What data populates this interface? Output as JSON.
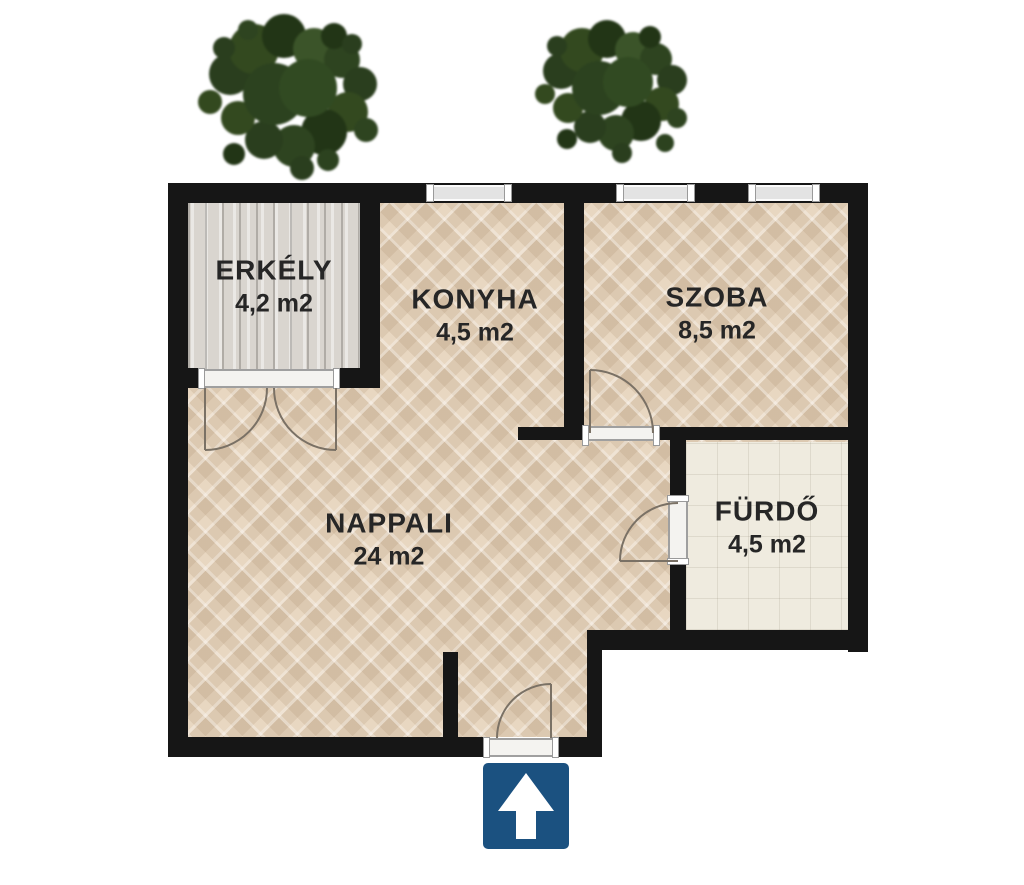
{
  "plan": {
    "title": "apartment-floor-plan",
    "rooms": [
      {
        "name": "ERKÉLY",
        "area": "4,2 m2"
      },
      {
        "name": "KONYHA",
        "area": "4,5 m2"
      },
      {
        "name": "SZOBA",
        "area": "8,5 m2"
      },
      {
        "name": "NAPPALI",
        "area": "24 m2"
      },
      {
        "name": "FÜRDŐ",
        "area": "4,5 m2"
      }
    ],
    "entrance_sign": {
      "icon": "arrow-up-icon",
      "color": "#1b5180"
    },
    "decorations": [
      "tree-icon",
      "tree-icon"
    ],
    "colors": {
      "wall": "#161616",
      "parquet_floor": "#e8d7c1",
      "balcony_floor": "#d9d5cf",
      "bathroom_floor": "#efebdf",
      "text": "#262626"
    }
  }
}
